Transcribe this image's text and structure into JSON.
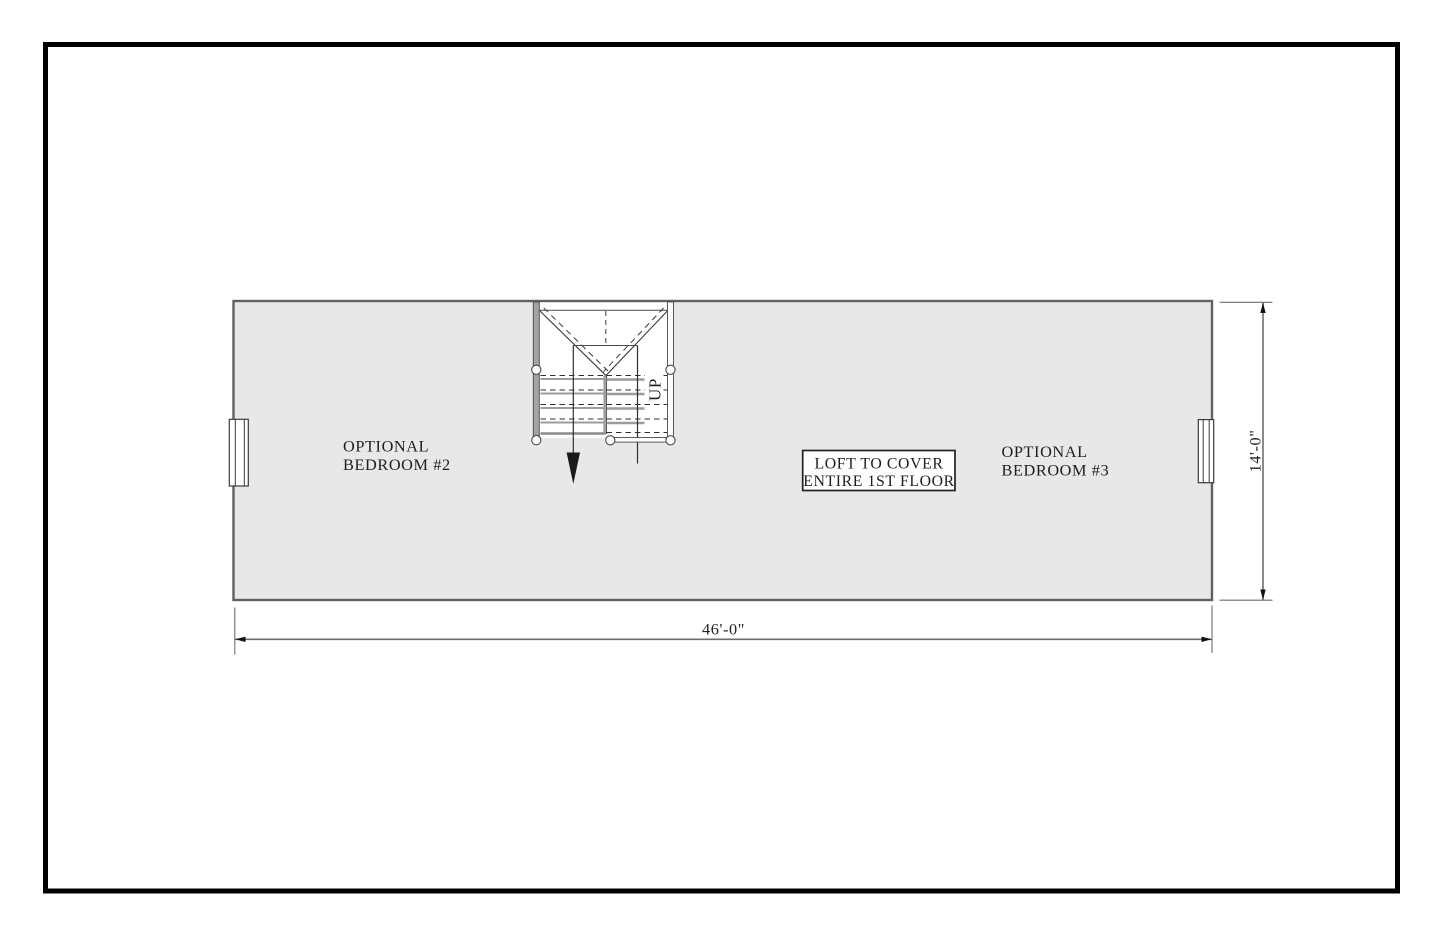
{
  "sheet": {
    "background": "#ffffff",
    "border_color": "#000000"
  },
  "plan": {
    "fill_color": "#e8e8e8",
    "wall_color": "#616161",
    "line_color": "#3a3a3a",
    "tread_gray_color": "#9c9c9c",
    "rail_fill_color": "#a3a3a3",
    "dimension_color": "#6e6e6e",
    "text_color": "#1e1e1e",
    "rooms": [
      {
        "label_lines": [
          "OPTIONAL",
          "BEDROOM #2"
        ]
      },
      {
        "label_lines": [
          "OPTIONAL",
          "BEDROOM #3"
        ]
      }
    ],
    "note": {
      "lines": [
        "LOFT TO COVER",
        "ENTIRE 1ST FLOOR"
      ]
    },
    "stair": {
      "direction_label": "UP"
    },
    "dimensions": {
      "width": "46'-0\"",
      "height": "14'-0\""
    }
  }
}
